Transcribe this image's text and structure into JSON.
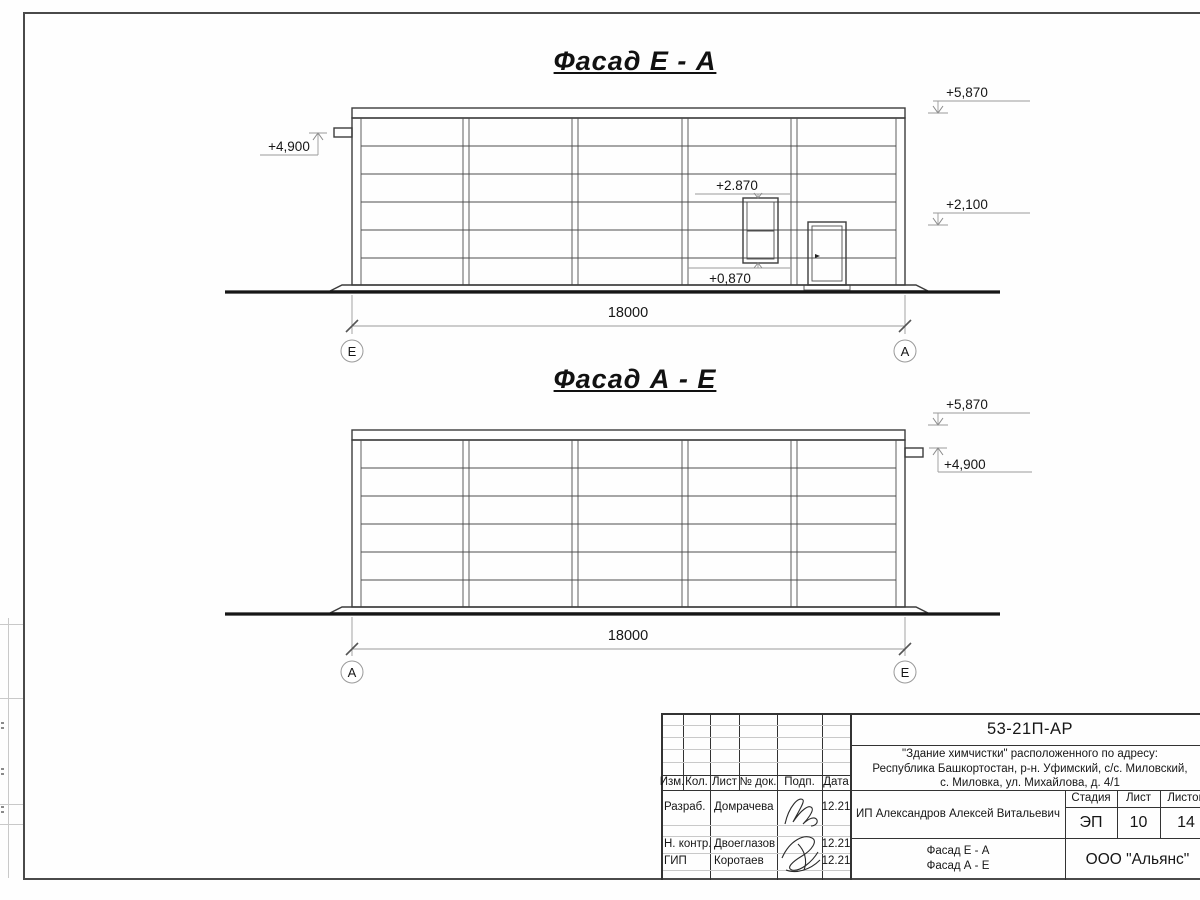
{
  "facade1": {
    "title": "Фасад Е - А",
    "dimension": "18000",
    "axis_left": "Е",
    "axis_right": "А",
    "marks": {
      "top_right": "+5,870",
      "left": "+4,900",
      "window_top": "+2.870",
      "mid_right": "+2,100",
      "window_bottom": "+0,870"
    }
  },
  "facade2": {
    "title": "Фасад А - Е",
    "dimension": "18000",
    "axis_left": "А",
    "axis_right": "Е",
    "marks": {
      "top_right": "+5,870",
      "right": "+4,900"
    }
  },
  "title_block": {
    "doc_code": "53-21П-АР",
    "project_line1": "\"Здание химчистки\" расположенного по адресу:",
    "project_line2": "Республика Башкортостан, р-н. Уфимский, с/с. Миловский,",
    "project_line3": "с. Миловка, ул. Михайлова, д. 4/1",
    "columns": {
      "izm": "Изм.",
      "kol": "Кол.",
      "list": "Лист",
      "doc": "№ док.",
      "podp": "Подп.",
      "data": "Дата"
    },
    "rows": [
      {
        "role": "Разраб.",
        "name": "Домрачева",
        "date": "12.21"
      },
      {
        "role": "Н. контр.",
        "name": "Двоеглазов",
        "date": "12.21"
      },
      {
        "role": "ГИП",
        "name": "Коротаев",
        "date": "12.21"
      }
    ],
    "client": "ИП Александров Алексей Витальевич",
    "stage_label": "Стадия",
    "sheet_label": "Лист",
    "sheets_label": "Листов",
    "stage": "ЭП",
    "sheet_no": "10",
    "sheets_total": "14",
    "drawing_name_line1": "Фасад Е - А",
    "drawing_name_line2": "Фасад А - Е",
    "company": "ООО \"Альянс\""
  }
}
